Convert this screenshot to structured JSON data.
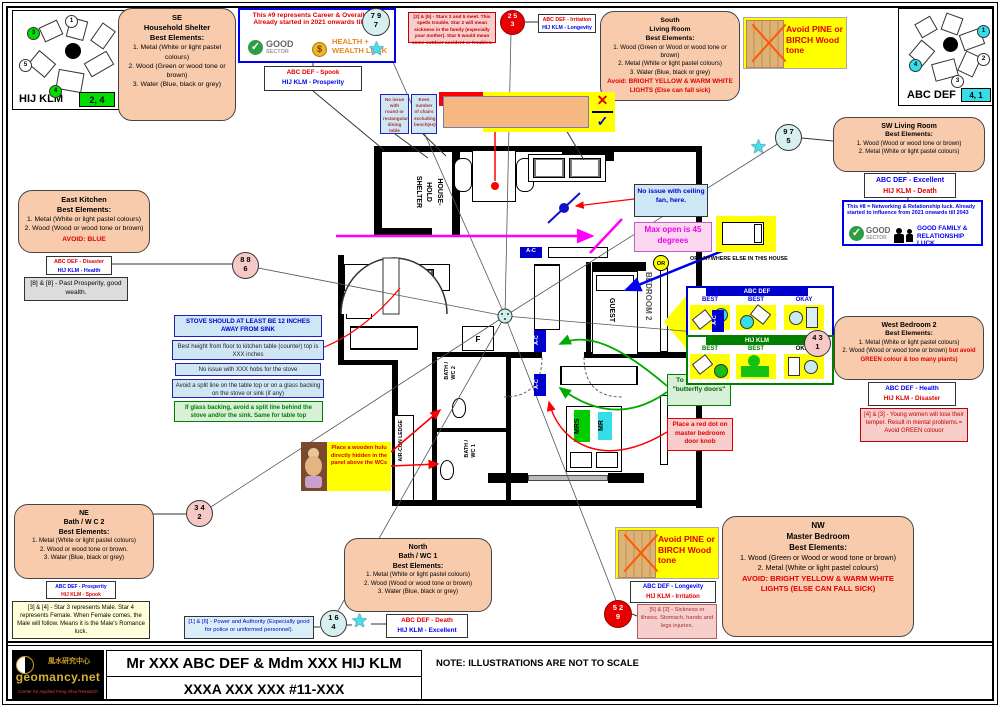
{
  "icons": {
    "check": "✓",
    "cross": "✕",
    "tick": "✓",
    "star": "★",
    "dollar": "$"
  },
  "colors": {
    "peach": "#F8CBAD",
    "annotation_yellow": "#FFFF00",
    "magenta": "#FF00FF",
    "red": "#FF0000",
    "blue": "#0000EE",
    "green": "#00AA00",
    "cyan_badge": "#35DDE8",
    "green_badge": "#00DD00",
    "lightblue_note": "#CFE7F5",
    "pink_note": "#F8CECC",
    "green_note": "#D8F0D8"
  },
  "compass_left": {
    "label": "HIJ KLM",
    "badge": "2, 4",
    "circles": [
      "3",
      "1",
      "5",
      "4"
    ]
  },
  "compass_right": {
    "label": "ABC DEF",
    "badge": "4, 1",
    "circles": [
      "1",
      "2",
      "3",
      "4"
    ]
  },
  "legend": {
    "career_text": "This #9 represents Career & Overall luck. Already started in 2021 onwards till 2043",
    "good": "GOOD",
    "sector": "SECTOR",
    "health_wealth": "HEALTH + WEALTH LUCK",
    "networking_text": "This #8 = Networking & Relationship luck. Already started to influence from 2021 onwards till 2043",
    "family_luck": "GOOD FAMILY & RELATIONSHIP LUCK"
  },
  "pairs": {
    "spook": {
      "a": "ABC DEF - Spook",
      "b": "HIJ KLM - Prosperity"
    },
    "irritation": {
      "a": "ABC DEF - Irritation",
      "b": "HIJ KLM - Longevity"
    },
    "excellent": {
      "a": "ABC DEF - Excellent",
      "b": "HIJ KLM - Death"
    },
    "disaster": {
      "a": "ABC DEF - Disaster",
      "b": "HIJ KLM - Health"
    },
    "health": {
      "a": "ABC DEF - Health",
      "b": "HIJ KLM - Disaster"
    },
    "prosperity": {
      "a": "ABC DEF - Prosperity",
      "b": "HIJ KLM - Spook"
    },
    "death": {
      "a": "ABC DEF - Death",
      "b": "HIJ KLM - Excellent"
    },
    "longevity": {
      "a": "ABC DEF - Longevity",
      "b": "HIJ KLM - Irritation"
    }
  },
  "circles": {
    "c797": {
      "t": "7 9",
      "b": "7"
    },
    "c253": {
      "t": "2 5",
      "b": "3"
    },
    "c975": {
      "t": "9 7",
      "b": "5"
    },
    "c886": {
      "t": "8 8",
      "b": "6"
    },
    "c431": {
      "t": "4 3",
      "b": "1"
    },
    "c342": {
      "t": "3 4",
      "b": "2"
    },
    "c164": {
      "t": "1 6",
      "b": "4"
    },
    "c529": {
      "t": "5 2",
      "b": "9"
    }
  },
  "rooms": {
    "se": {
      "l1": "SE",
      "l2": "Household Shelter",
      "l3": "Best Elements:",
      "items": [
        "1. Metal (White or light pastel colours)",
        "2. Wood (Green or wood tone or brown)",
        "3. Water (Blue, black or grey)"
      ]
    },
    "south": {
      "l1": "South",
      "l2": "Living Room",
      "l3": "Best Elements:",
      "items": [
        "1. Wood (Green or Wood or wood tone or brown)",
        "2. Metal (White or light pastel colours)",
        "3. Water (Blue, black or grey)"
      ],
      "avoid": "Avoid: BRIGHT YELLOW & WARM WHITE LIGHTS  (Else can fall sick)"
    },
    "sw": {
      "l1": "SW Living Room",
      "l3": "Best Elements:",
      "items": [
        "1. Wood (Wood or wood tone or brown)",
        "2. Metal (White or light pastel colours)"
      ]
    },
    "east": {
      "l1": "East Kitchen",
      "l3": "Best Elements:",
      "items": [
        "1. Metal (White or light pastel colours)",
        "2. Wood (Wood or wood tone or brown)"
      ],
      "avoid": "AVOID: BLUE"
    },
    "west": {
      "l1": "West Bedroom 2",
      "l3": "Best Elements:",
      "items": [
        "1. Metal (White or light pastel colours)"
      ],
      "item2_black": "2. Wood (Wood or wood tone or brown) ",
      "item2_red": "but avoid GREEN colour & too many plants)"
    },
    "ne": {
      "l1": "NE",
      "l2": "Bath / W C 2",
      "l3": "Best Elements:",
      "items": [
        "1. Metal (White or light pastel colours)",
        "2. Wood or wood tone or brown.",
        "3. Water (Blue, black or grey)"
      ]
    },
    "north": {
      "l1": "North",
      "l2": "Bath / WC 1",
      "l3": "Best Elements:",
      "items": [
        "1. Metal (White or light pastel colours)",
        "2. Wood (Wood or wood tone or brown)",
        "3. Water (Blue, black or grey)"
      ]
    },
    "nw": {
      "l1": "NW",
      "l2": "Master Bedroom",
      "l3": "Best Elements:",
      "items": [
        "1. Wood (Green or Wood or wood tone or brown)",
        "2. Metal (White or light pastel colours)"
      ],
      "avoid": "AVOID: BRIGHT YELLOW & WARM WHITE LIGHTS (ELSE CAN FALL SICK)"
    }
  },
  "notes": {
    "stars25": "[2] & [5] - Stars 2 and 5 meet.  This spells trouble. Star 2 will mean sickness in the family (especially your mother). Star 5 would mean some outdoor accident or troubles.",
    "east88": "[8] & [8] - Past Prosperity, good wealth.",
    "west43": "[4] & [3] - Young women will lose their temper. Result in mental problems.= Avoid GREEN colouor",
    "ne34": "[3] & [4] - Star 3 represents Male. Star 4 represents Female. When Female comes, the Male will follow. Means it is the Male's Romance luck.",
    "north16": "[1] & [6] - Power and Authority (Especially good for police or uniformed personnel).",
    "nw52": "[5] & [2] - Sickness or illness. Stomach, hands and legs injuries.",
    "dining1": "No issue with round or rectangular dining table",
    "dining2": "Even number of chairs excluding bench(es)",
    "stove1": "STOVE SHOULD AT LEAST BE 12 INCHES AWAY FROM SINK",
    "stove2": "Best height from floor to kitchen table (counter) top is XXX inches",
    "stove3": "No issue with XXX  hobs for the stove",
    "stove4": "Avoid a split line on the table top or on a glass backing on the stove or sink (if any)",
    "stove5": "If glass backing, avoid a split line behind the stove and/or the sink. Same for table top",
    "fan": "No issue with ceiling fan, here.",
    "maxopen": "Max open is 45 degrees",
    "butterfly": "To discuss the \"butterfly doors\"",
    "reddot": "Place a red dot on master bedroom door knob",
    "hulu": "Place a wooden hulu directly hidden in the panel above the WCs",
    "avoid_pine": "Avoid PINE or BIRCH Wood tone",
    "or_anywhere": "OR ANYWHERE ELSE IN THIS HOUSE",
    "or": "OR"
  },
  "bed_panels": {
    "abc_header": "ABC DEF",
    "hij_header": "HIJ KLM",
    "labels": [
      "BEST",
      "BEST",
      "OKAY"
    ]
  },
  "plan": {
    "shelter": "HOUSE-\nHOLD\nSHELTER",
    "w": "W",
    "f": "F",
    "guest": "GUEST",
    "bedroom2": "BEDROOM 2",
    "bath2": "BATH /\nWC 2",
    "bath1": "BATH /\nWC 1",
    "aircon": "AIR-CON LEDGE",
    "mrs": "MRS",
    "mr": "MR",
    "ac": "A-C"
  },
  "footer": {
    "cn": "風水研究中心",
    "site": "geomancy.net",
    "tagline": "Center for Applied Feng Shui Research",
    "line1": "Mr XXX ABC DEF & Mdm XXX HIJ KLM",
    "line2": "XXXA XXX XXX #11-XXX",
    "note": "NOTE: ILLUSTRATIONS ARE NOT TO SCALE"
  }
}
